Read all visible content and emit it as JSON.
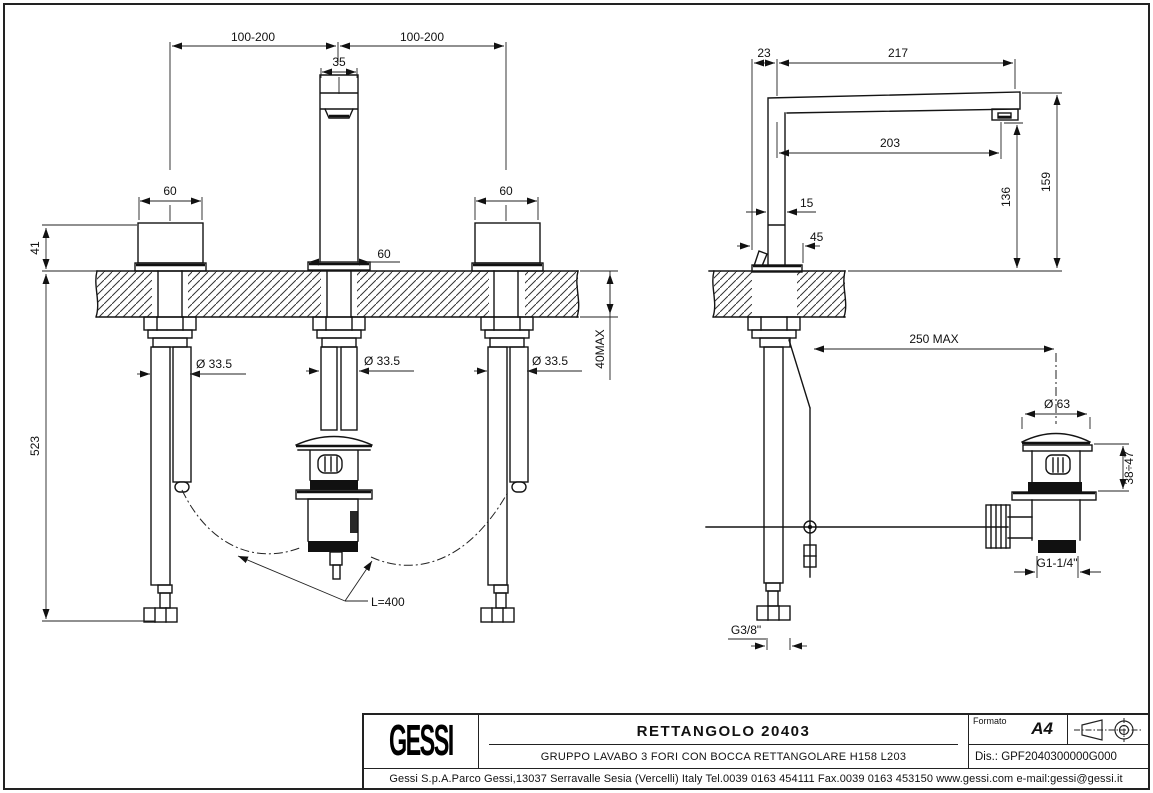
{
  "title_block": {
    "brand_logo": "GESSI",
    "product_title": "RETTANGOLO 20403",
    "product_subtitle": "GRUPPO LAVABO 3 FORI CON BOCCA RETTANGOLARE H158 L203",
    "format_label": "Formato",
    "format_value": "A4",
    "drawing_number": "Dis.: GPF2040300000G000",
    "company_footer": "Gessi S.p.A.Parco Gessi,13037 Serravalle Sesia (Vercelli) Italy Tel.0039 0163 454111 Fax.0039 0163 453150 www.gessi.com e-mail:gessi@gessi.it"
  },
  "front_view": {
    "dim_hole_spacing_left": "100-200",
    "dim_hole_spacing_right": "100-200",
    "dim_spout_width": "35",
    "dim_left_handle_width": "60",
    "dim_right_handle_width": "60",
    "dim_spout_base_width": "60",
    "dim_height_above_deck": "41",
    "dim_depth_below_deck": "523",
    "dim_hole_left": "Ø 33.5",
    "dim_hole_center": "Ø 33.5",
    "dim_hole_right": "Ø 33.5",
    "dim_deck_thickness": "40MAX",
    "dim_hose_length": "L=400"
  },
  "side_view": {
    "dim_body_offset": "23",
    "dim_spout_total_reach": "217",
    "dim_spout_reach": "203",
    "dim_aerator_height": "136",
    "dim_total_height": "159",
    "dim_body_width": "15",
    "dim_base_depth": "45",
    "dim_rod_max": "250 MAX",
    "dim_waste_cap": "Ø 63",
    "dim_waste_height_range": "38÷47",
    "dim_waste_thread": "G1-1/4\"",
    "dim_supply_thread": "G3/8\""
  }
}
